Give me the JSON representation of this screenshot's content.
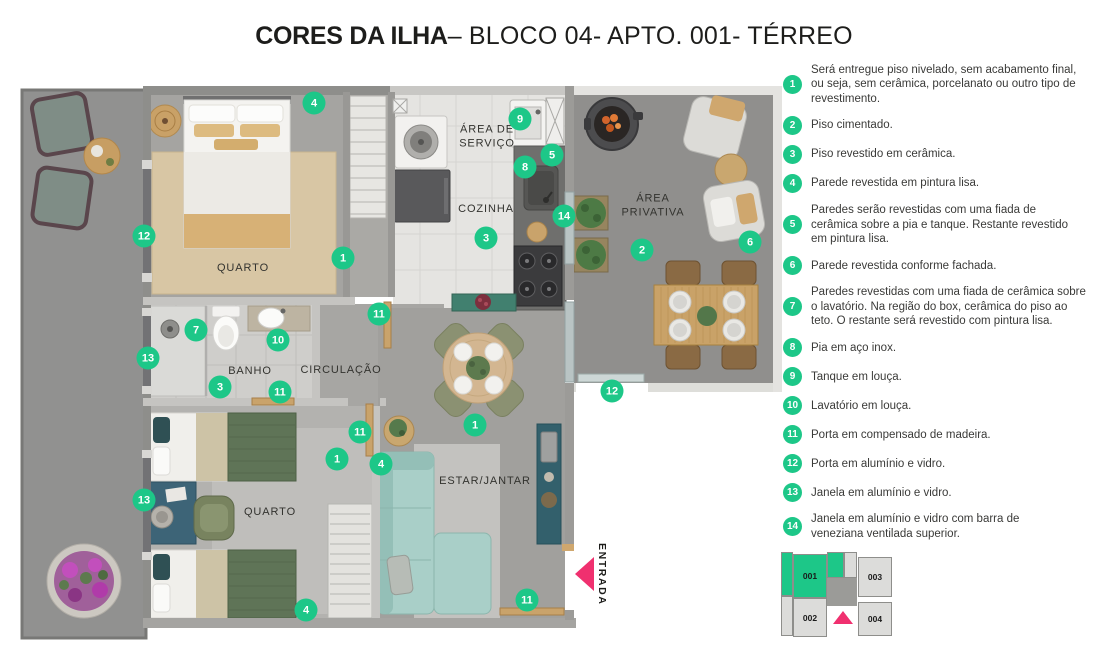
{
  "title": {
    "brand": "CORES DA ILHA",
    "rest": "– BLOCO 04- APTO. 001- TÉRREO"
  },
  "colors": {
    "accent_green": "#1dc788",
    "accent_pink": "#f0306f"
  },
  "plan": {
    "entrance_label": "ENTRADA",
    "room_labels": [
      {
        "id": "quarto-1",
        "text": "QUARTO",
        "x": 243,
        "y": 268
      },
      {
        "id": "area-de-servico",
        "text": "ÁREA DE\nSERVIÇO",
        "x": 487,
        "y": 137
      },
      {
        "id": "cozinha",
        "text": "COZINHA",
        "x": 486,
        "y": 209
      },
      {
        "id": "area-privativa",
        "text": "ÁREA\nPRIVATIVA",
        "x": 653,
        "y": 206
      },
      {
        "id": "banho",
        "text": "BANHO",
        "x": 250,
        "y": 371
      },
      {
        "id": "circulacao",
        "text": "CIRCULAÇÃO",
        "x": 341,
        "y": 370
      },
      {
        "id": "quarto-2",
        "text": "QUARTO",
        "x": 270,
        "y": 512
      },
      {
        "id": "estar-jantar",
        "text": "ESTAR/JANTAR",
        "x": 485,
        "y": 481
      }
    ],
    "markers": [
      {
        "n": "4",
        "x": 314,
        "y": 103
      },
      {
        "n": "9",
        "x": 520,
        "y": 119
      },
      {
        "n": "5",
        "x": 552,
        "y": 155
      },
      {
        "n": "8",
        "x": 525,
        "y": 167
      },
      {
        "n": "12",
        "x": 144,
        "y": 236
      },
      {
        "n": "14",
        "x": 564,
        "y": 216
      },
      {
        "n": "3",
        "x": 486,
        "y": 238
      },
      {
        "n": "1",
        "x": 343,
        "y": 258
      },
      {
        "n": "2",
        "x": 642,
        "y": 250
      },
      {
        "n": "6",
        "x": 750,
        "y": 242
      },
      {
        "n": "7",
        "x": 196,
        "y": 330
      },
      {
        "n": "10",
        "x": 278,
        "y": 340
      },
      {
        "n": "11",
        "x": 379,
        "y": 314
      },
      {
        "n": "13",
        "x": 148,
        "y": 358
      },
      {
        "n": "3",
        "x": 220,
        "y": 387
      },
      {
        "n": "11",
        "x": 280,
        "y": 392
      },
      {
        "n": "12",
        "x": 612,
        "y": 391
      },
      {
        "n": "1",
        "x": 475,
        "y": 425
      },
      {
        "n": "11",
        "x": 360,
        "y": 432
      },
      {
        "n": "1",
        "x": 337,
        "y": 459
      },
      {
        "n": "4",
        "x": 381,
        "y": 464
      },
      {
        "n": "13",
        "x": 144,
        "y": 500
      },
      {
        "n": "11",
        "x": 527,
        "y": 600
      },
      {
        "n": "4",
        "x": 306,
        "y": 610
      }
    ]
  },
  "legend": {
    "items": [
      {
        "num": "1",
        "text": "Será entregue piso nivelado, sem acabamento final,\nou seja, sem cerâmica, porcelanato ou outro tipo de\nrevestimento."
      },
      {
        "num": "2",
        "text": "Piso cimentado."
      },
      {
        "num": "3",
        "text": "Piso revestido em cerâmica."
      },
      {
        "num": "4",
        "text": "Parede revestida em pintura lisa."
      },
      {
        "num": "5",
        "text": "Paredes serão revestidas com uma fiada de\ncerâmica sobre a pia e tanque. Restante revestido\nem pintura lisa."
      },
      {
        "num": "6",
        "text": "Parede revestida conforme fachada."
      },
      {
        "num": "7",
        "text": "Paredes revestidas com uma fiada de cerâmica sobre\no lavatório. Na região do box, cerâmica do piso ao\nteto. O restante será revestido com pintura lisa."
      },
      {
        "num": "8",
        "text": "Pia em aço inox."
      },
      {
        "num": "9",
        "text": "Tanque em louça."
      },
      {
        "num": "10",
        "text": "Lavatório em louça."
      },
      {
        "num": "11",
        "text": "Porta em compensado de madeira."
      },
      {
        "num": "12",
        "text": "Porta em alumínio e vidro."
      },
      {
        "num": "13",
        "text": "Janela em alumínio e vidro."
      },
      {
        "num": "14",
        "text": "Janela em alumínio e vidro com barra de\nveneziana ventilada superior."
      }
    ]
  },
  "keyplan": {
    "units": [
      {
        "id": "001",
        "highlighted": true
      },
      {
        "id": "002",
        "highlighted": false
      },
      {
        "id": "003",
        "highlighted": false
      },
      {
        "id": "004",
        "highlighted": false
      }
    ]
  }
}
